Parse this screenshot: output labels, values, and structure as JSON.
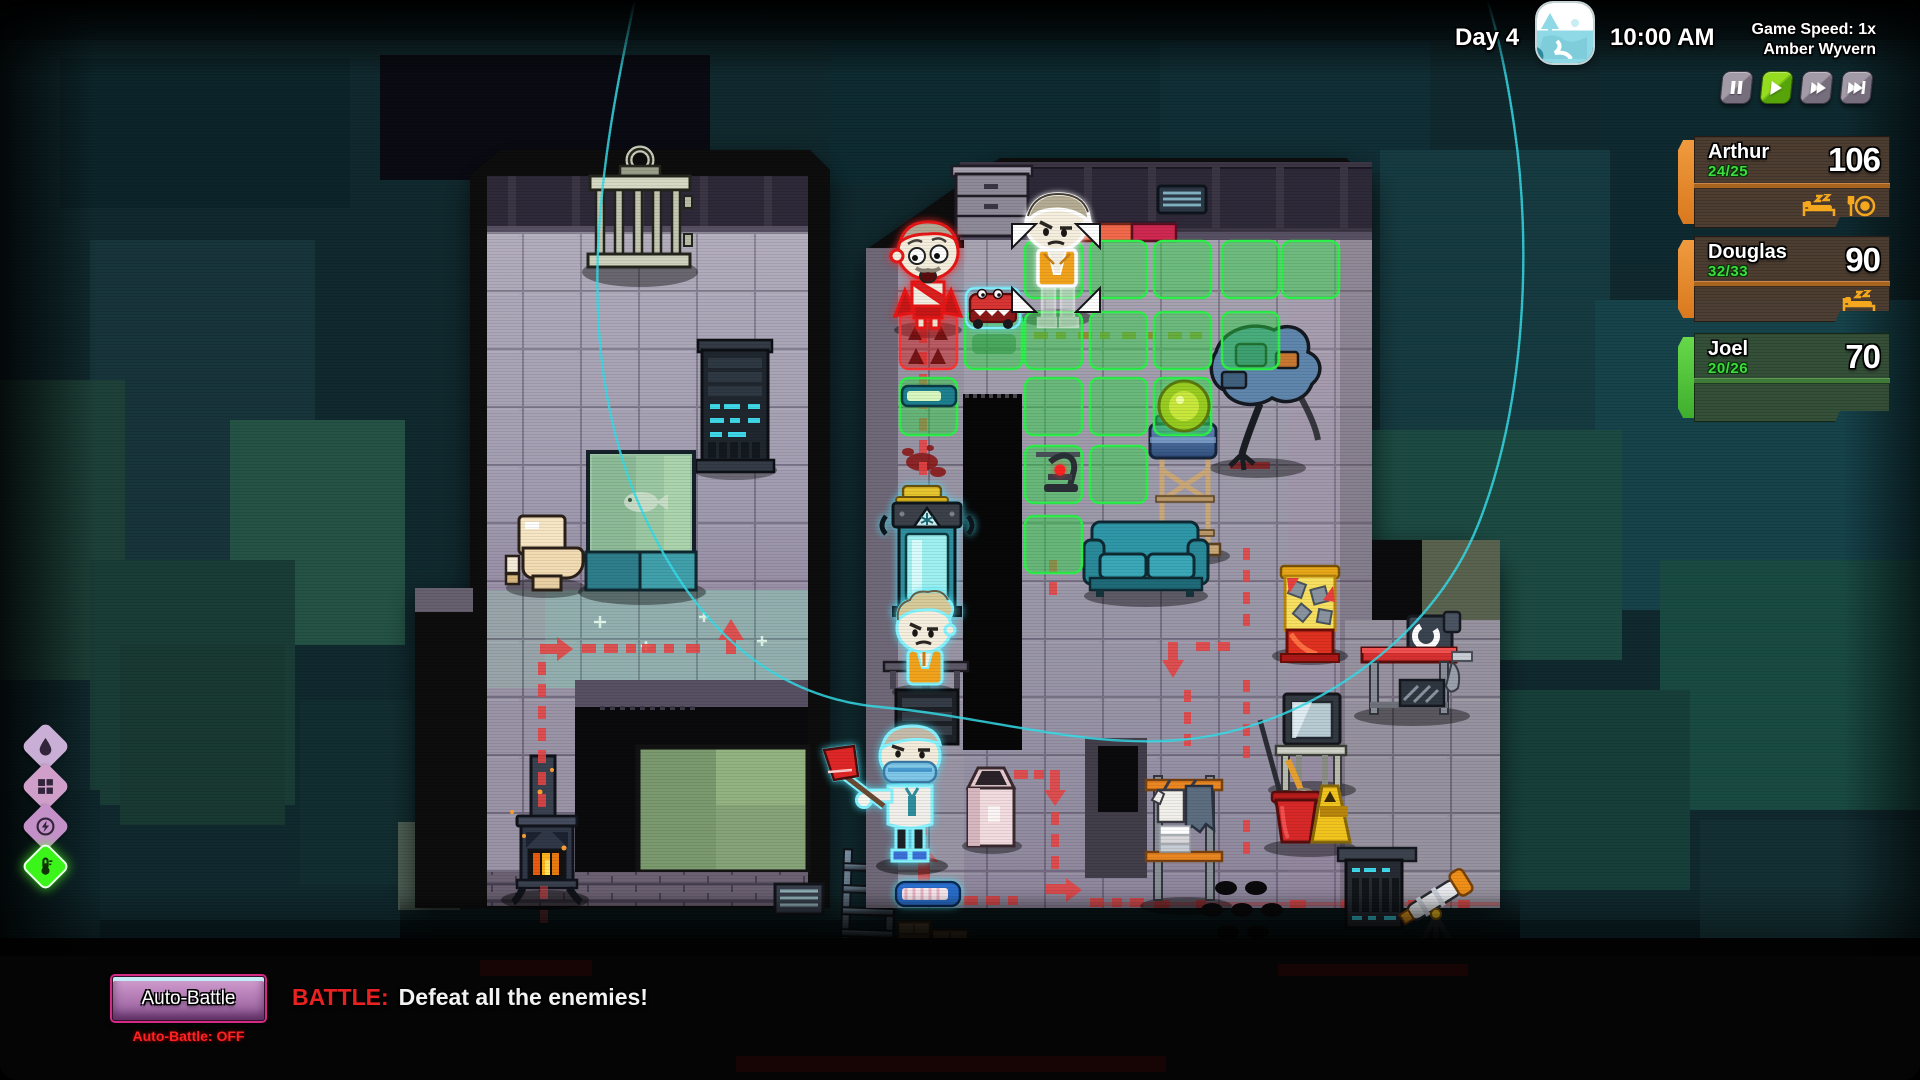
{
  "hud": {
    "day": "Day 4",
    "time": "10:00 AM",
    "speed": "Game Speed: 1x",
    "ship_name": "Amber Wyvern",
    "day_icon": "daytime-landscape-icon",
    "playback": [
      {
        "id": "pause",
        "icon": "pause-icon",
        "active": false
      },
      {
        "id": "play",
        "icon": "play-icon",
        "active": true
      },
      {
        "id": "fast-forward",
        "icon": "fast-forward-icon",
        "active": false
      },
      {
        "id": "skip-turn",
        "icon": "skip-to-end-icon",
        "active": false
      }
    ]
  },
  "party": [
    {
      "name": "Arthur",
      "hp": "24/25",
      "value": "106",
      "needs": [
        "sleep",
        "hunger"
      ],
      "theme": "brown"
    },
    {
      "name": "Douglas",
      "hp": "32/33",
      "value": "90",
      "needs": [
        "sleep"
      ],
      "theme": "brown"
    },
    {
      "name": "Joel",
      "hp": "20/26",
      "value": "70",
      "needs": [],
      "theme": "green"
    }
  ],
  "resource_icons": [
    {
      "id": "water",
      "icon": "water-drop-icon",
      "color": "#c9aed6"
    },
    {
      "id": "storage",
      "icon": "blocks-icon",
      "color": "#cf9fca"
    },
    {
      "id": "power",
      "icon": "power-bolt-icon",
      "color": "#c490c8"
    },
    {
      "id": "temperature",
      "icon": "thermometer-icon",
      "color": "#3bf51a"
    }
  ],
  "battle": {
    "auto_battle_button": "Auto-Battle",
    "auto_battle_status": "Auto-Battle: OFF",
    "objective_label": "BATTLE:",
    "objective_text": "Defeat all the enemies!"
  },
  "colors": {
    "move_tile": "#2ee84c",
    "danger_tile": "#e02222",
    "enemy_outline": "#ff2020",
    "ally_outline": "#7ff0ff",
    "selected_outline": "#ffffff",
    "path_red": "#e84545",
    "curve_cyan": "#35dce8",
    "hp_green": "#3ddc3d",
    "panel_brown": "#524032",
    "panel_green": "#385238"
  },
  "map": {
    "characters": [
      {
        "id": "enemy-survivor",
        "outline": "enemy",
        "tile": [
          900,
          312
        ]
      },
      {
        "id": "selected-survivor",
        "outline": "selected",
        "tile": [
          1025,
          241
        ]
      },
      {
        "id": "vest-survivor",
        "outline": "ally",
        "tile": [
          897,
          592
        ]
      },
      {
        "id": "scientist-survivor",
        "outline": "ally",
        "tile": [
          880,
          716
        ]
      }
    ],
    "movement_tiles": [
      [
        1025,
        241
      ],
      [
        1090,
        241
      ],
      [
        1154,
        241
      ],
      [
        1222,
        241
      ],
      [
        1282,
        241
      ],
      [
        965,
        312
      ],
      [
        1025,
        312
      ],
      [
        1090,
        312
      ],
      [
        1154,
        312
      ],
      [
        1222,
        312
      ],
      [
        900,
        378
      ],
      [
        1025,
        378
      ],
      [
        1090,
        378
      ],
      [
        1154,
        378
      ],
      [
        1025,
        446
      ],
      [
        1090,
        446
      ],
      [
        1025,
        516
      ]
    ],
    "danger_tiles": [
      [
        900,
        312
      ]
    ],
    "furniture": [
      "jail-cell-door",
      "server-rack",
      "fish-tank",
      "toilet",
      "wood-stove",
      "ladder",
      "window-room",
      "cabinet",
      "wall-vent",
      "cryo-fridge",
      "bunk-stairs",
      "railing",
      "loading-bar",
      "loading-bar",
      "toy-car",
      "microscope",
      "couch",
      "water-tower",
      "generator-orb",
      "wrecked-robot",
      "mineral-display",
      "workbench",
      "crt-tv",
      "clothes-rack",
      "mop-bucket",
      "wet-floor-sign",
      "broom",
      "floor-holes",
      "server-cabinet",
      "telescope",
      "cardboard-boxes"
    ]
  }
}
